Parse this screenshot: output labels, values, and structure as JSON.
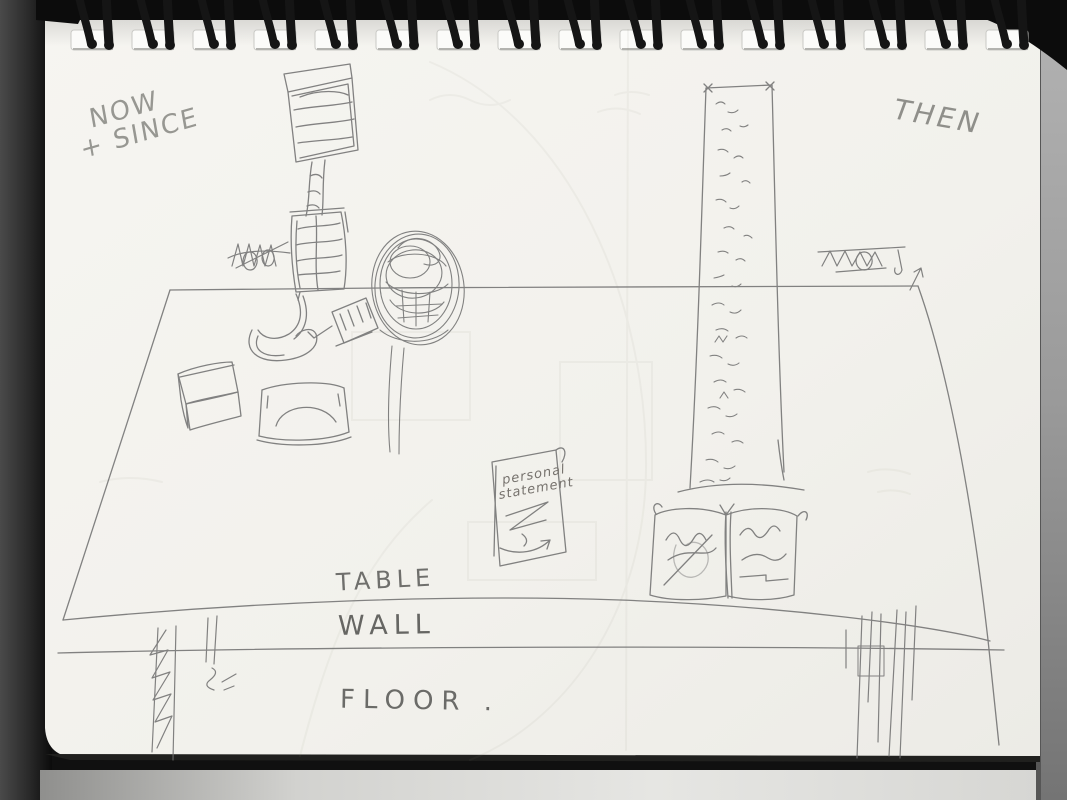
{
  "labels": {
    "now_since_1": "NOW",
    "now_since_2": "+ SINCE",
    "then": "THEN",
    "table": "TABLE",
    "wall": "WALL",
    "floor": "FLOOR .",
    "note_1": "personal",
    "note_2": "statement"
  },
  "binding": {
    "loop_count": 16
  },
  "colors": {
    "page": "#f3f2ed",
    "pencil": "#6e6e6e",
    "faint": "#8a8a78",
    "binding_wire": "#141414",
    "scanner_left": "#3c3c3c",
    "scanner_right": "#8f8f8f",
    "bottom_strip": "#d9d9d6"
  },
  "sketch_objects": [
    "desk-lamp",
    "crossed-out-scribble-left",
    "round-wreath-on-stand",
    "ladle",
    "hand-brush",
    "small-box",
    "tray",
    "personal-statement-note",
    "tall-panel-with-writing",
    "open-book",
    "crossed-out-scribble-right",
    "table-legs"
  ]
}
